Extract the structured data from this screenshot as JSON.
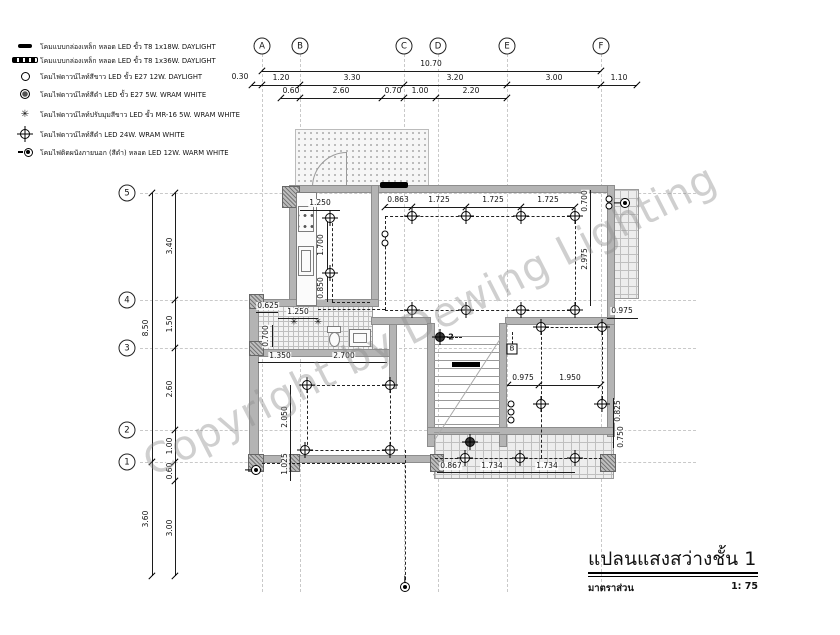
{
  "legend": {
    "items": [
      {
        "icon": "t8-batten-1x18w",
        "label": "โคมแบบกล่องเหล็ก หลอด LED ขั้ว T8 1x18W. DAYLIGHT"
      },
      {
        "icon": "t8-batten-1x36w",
        "label": "โคมแบบกล่องเหล็ก หลอด LED ขั้ว T8 1x36W. DAYLIGHT"
      },
      {
        "icon": "downlight-white",
        "label": "โคมไฟดาวน์ไลท์สีขาว LED ขั้ว E27 12W. DAYLIGHT"
      },
      {
        "icon": "downlight-black",
        "label": "โคมไฟดาวน์ไลท์สีดำ LED ขั้ว E27 5W. WRAM WHITE"
      },
      {
        "icon": "downlight-adjustable",
        "label": "โคมไฟดาวน์ไลท์ปรับมุมสีขาว LED ขั้ว MR-16 5W. WRAM WHITE"
      },
      {
        "icon": "downlight-24w",
        "label": "โคมไฟดาวน์ไลท์สีดำ LED 24W. WRAM WHITE"
      },
      {
        "icon": "wall-lamp",
        "label": "โคมไฟติดผนังภายนอก (สีดำ) หลอด LED 12W. WARM WHITE"
      }
    ]
  },
  "grid": {
    "columns": [
      "A",
      "B",
      "C",
      "D",
      "E",
      "F"
    ],
    "rows": [
      "5",
      "4",
      "3",
      "2",
      "1"
    ]
  },
  "dimensions": {
    "top_overall": "10.70",
    "top_row2": [
      "0.30",
      "1.20",
      "3.30",
      "3.20",
      "3.00",
      "1.10"
    ],
    "top_row3": [
      "0.60",
      "2.60",
      "0.70",
      "1.00",
      "2.20"
    ],
    "left_overall": "8.50",
    "left_row": [
      "3.40",
      "1.50",
      "2.60",
      "1.00",
      "0.60"
    ],
    "left_bottom": [
      "3.60",
      "3.00"
    ],
    "plan_horizontal": [
      "1.250",
      "0.863",
      "1.725",
      "1.725",
      "1.725",
      "0.625",
      "1.250",
      "1.350",
      "2.700",
      "0.975",
      "1.950",
      "0.975",
      "0.867",
      "1.734",
      "1.734"
    ],
    "plan_vertical": [
      "1.700",
      "0.850",
      "0.700",
      "0.700",
      "2.975",
      "2.050",
      "1.025",
      "0.825",
      "0.750"
    ]
  },
  "annotations": {
    "stair_fixture_count": "2",
    "circuit_label": "B"
  },
  "watermark": "Copyright by Dewing Lighting",
  "titleblock": {
    "title": "แปลนแสงสว่างชั้น 1",
    "scale_label": "มาตราส่วน",
    "scale_value": "1: 75"
  },
  "colors": {
    "line": "#1a1a1a",
    "wall": "#b4b4b4",
    "grid": "#c9c9c9",
    "tile": "#ededed",
    "watermark": "#8c8c8c"
  }
}
